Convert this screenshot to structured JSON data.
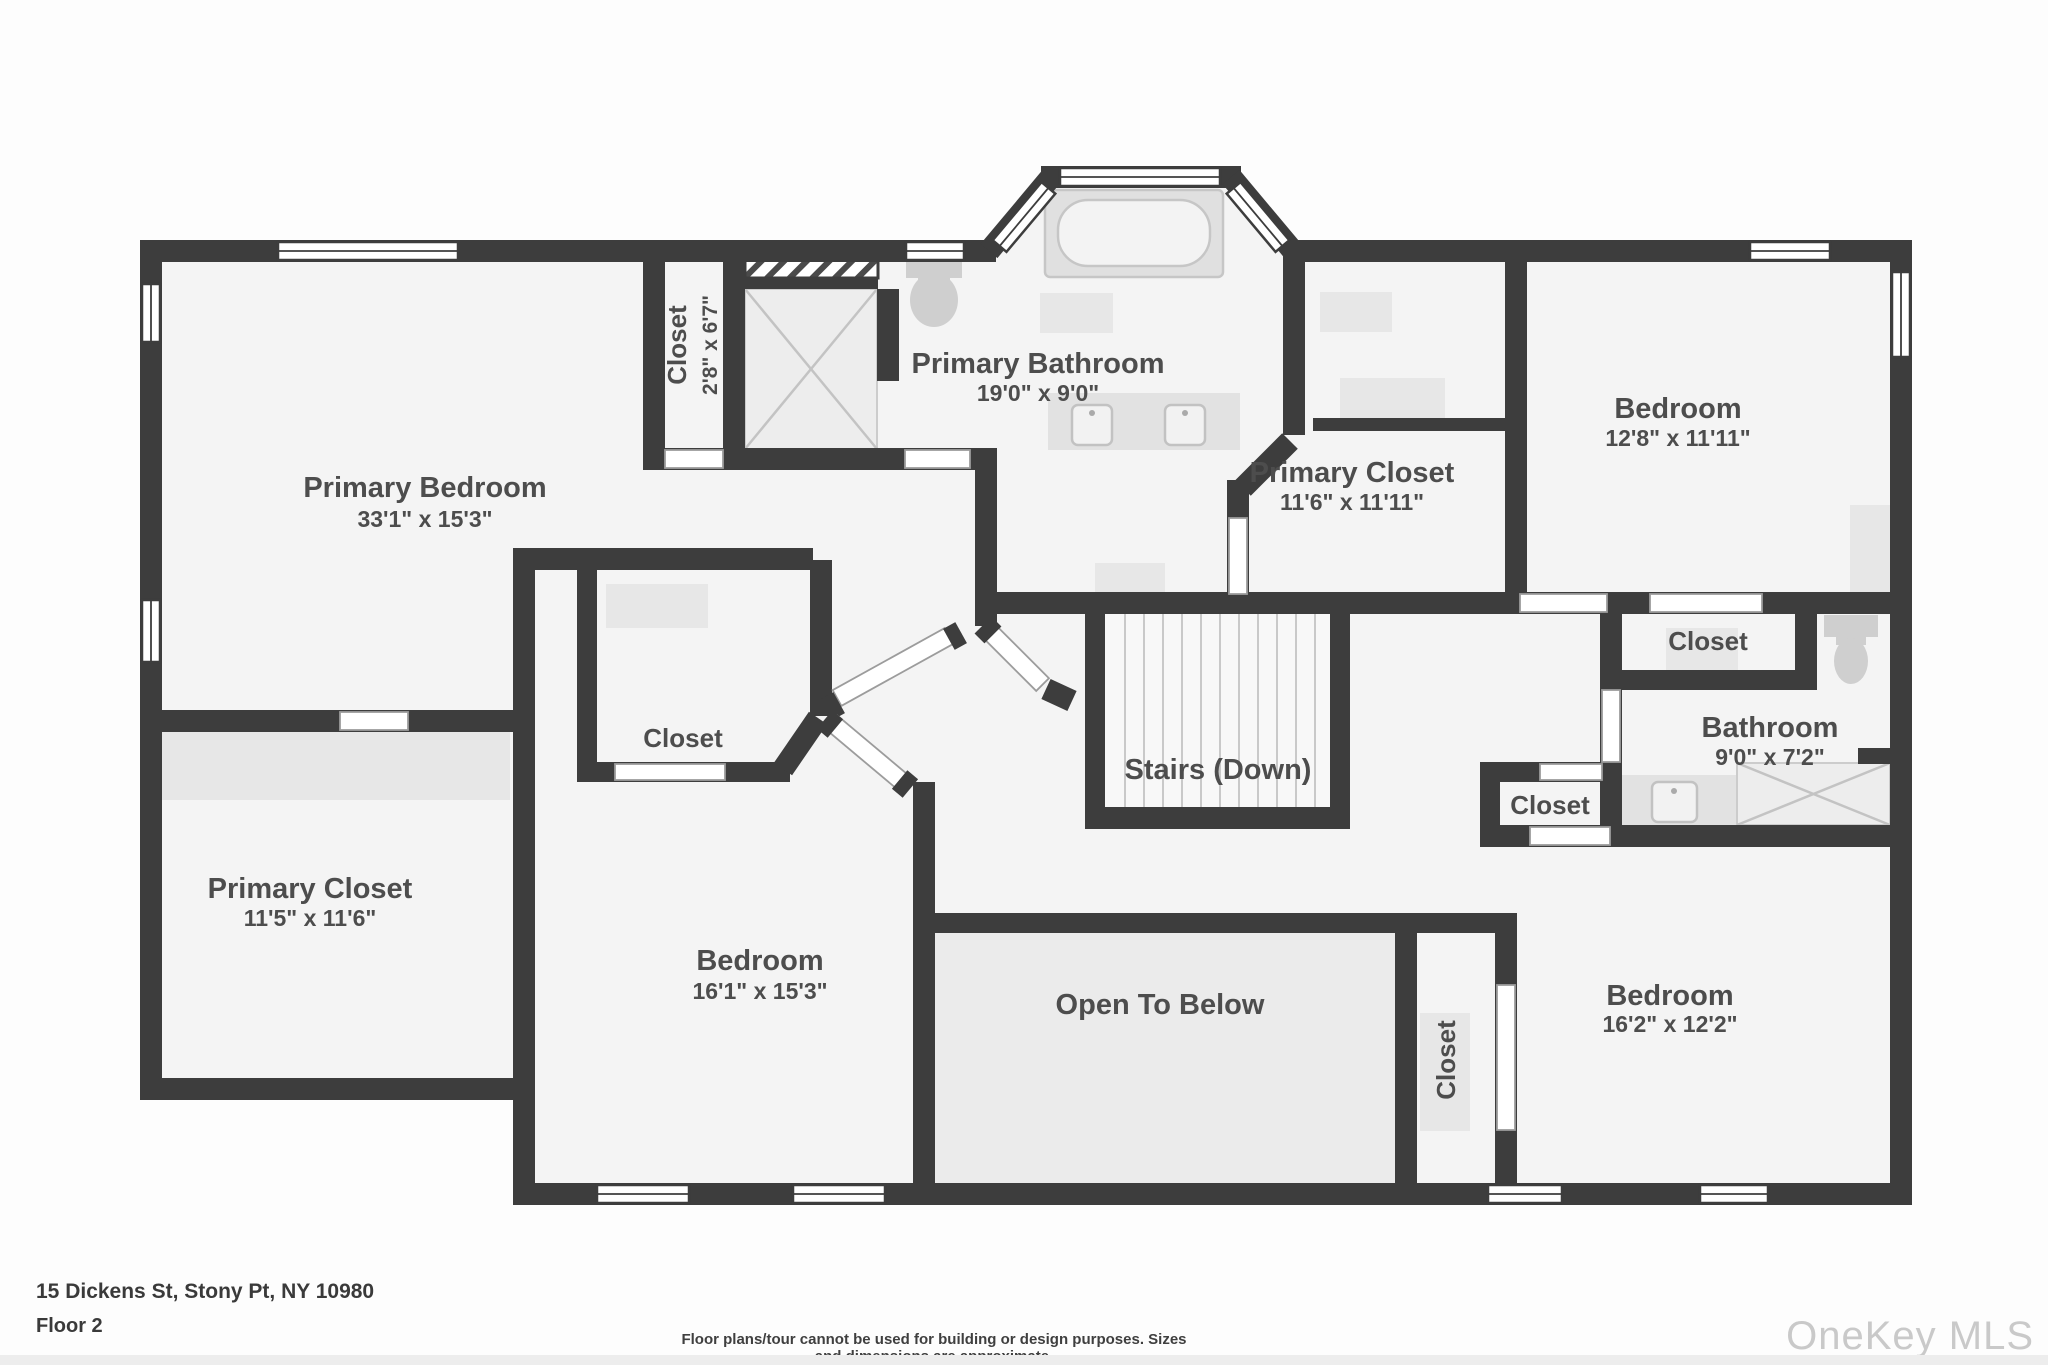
{
  "meta": {
    "address": "15 Dickens St, Stony Pt, NY 10980",
    "floor": "Floor 2",
    "disclaimer": "Floor plans/tour cannot be used for building or design purposes. Sizes and dimensions are approximate.",
    "watermark": "OneKey MLS"
  },
  "colors": {
    "wall": "#3d3d3d",
    "floor": "#f4f4f4",
    "floor_open_to_below": "#ebebeb",
    "label": "#4d4d4d",
    "fixture": "#e2e2e2",
    "watermark": "#c9c9c9"
  },
  "rooms": [
    {
      "name": "Primary Bedroom",
      "dims": "33'1\" x 15'3\""
    },
    {
      "name": "Closet",
      "dims": "2'8\" x 6'7\""
    },
    {
      "name": "Primary Bathroom",
      "dims": "19'0\" x 9'0\""
    },
    {
      "name": "Primary Closet",
      "dims": "11'6\" x 11'11\""
    },
    {
      "name": "Bedroom",
      "dims": "12'8\" x 11'11\""
    },
    {
      "name": "Closet",
      "dims": ""
    },
    {
      "name": "Bathroom",
      "dims": "9'0\" x 7'2\""
    },
    {
      "name": "Closet",
      "dims": ""
    },
    {
      "name": "Stairs (Down)",
      "dims": ""
    },
    {
      "name": "Open To Below",
      "dims": ""
    },
    {
      "name": "Bedroom",
      "dims": "16'1\" x 15'3\""
    },
    {
      "name": "Primary Closet",
      "dims": "11'5\" x 11'6\""
    },
    {
      "name": "Closet",
      "dims": ""
    },
    {
      "name": "Closet",
      "dims": ""
    },
    {
      "name": "Bedroom",
      "dims": "16'2\" x 12'2\""
    }
  ]
}
